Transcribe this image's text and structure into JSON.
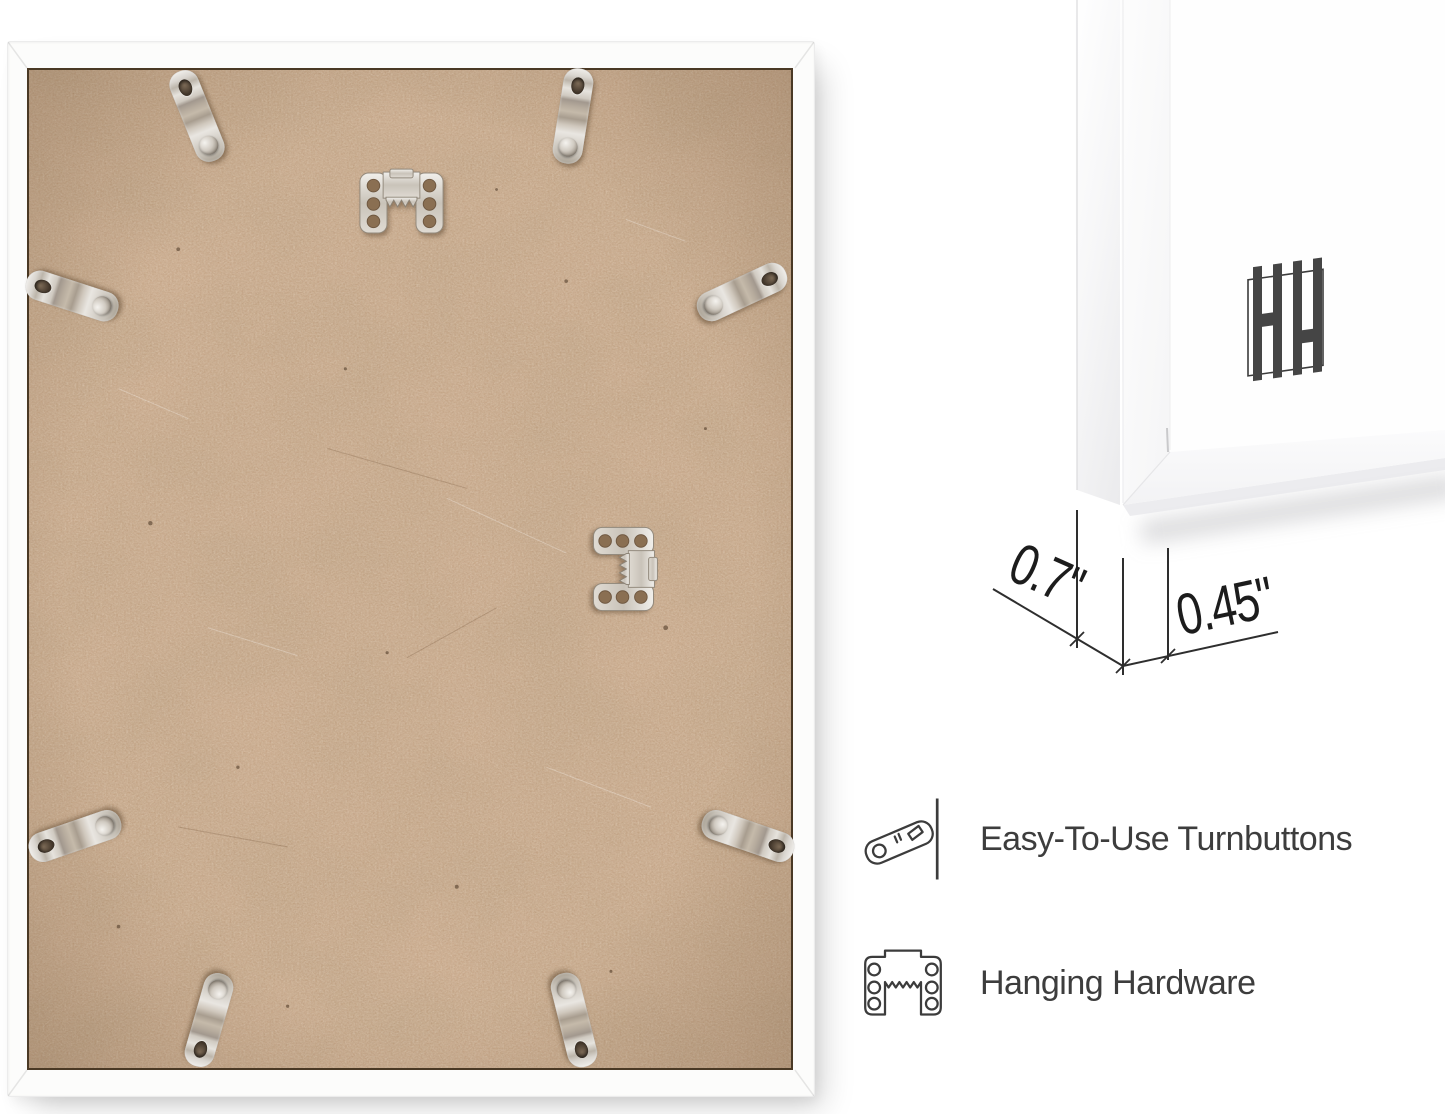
{
  "page": {
    "background_color": "#ffffff"
  },
  "photo": {
    "subject": "Back of white picture frame with MDF backing",
    "frame_color": "#fcfcfb",
    "backing_color": "#c8a687",
    "turnbutton_count": 8,
    "sawtooth_hanger_count": 2
  },
  "corner_render": {
    "subject": "Front corner of white frame with mat",
    "logo": "HH monogram logo",
    "dimensions": {
      "depth": "0.7\"",
      "face_width": "0.45\""
    }
  },
  "features": {
    "items": [
      {
        "icon": "turnbutton-icon",
        "label": "Easy-To-Use Turnbuttons"
      },
      {
        "icon": "hanging-hardware-icon",
        "label": "Hanging Hardware"
      }
    ]
  },
  "colors": {
    "feature_text": "#3d3d3d",
    "dimension_text": "#1c1c1c",
    "dimension_line": "#2e2e2e",
    "metal": "#cfc9c0",
    "cardboard": "#c8a687"
  }
}
